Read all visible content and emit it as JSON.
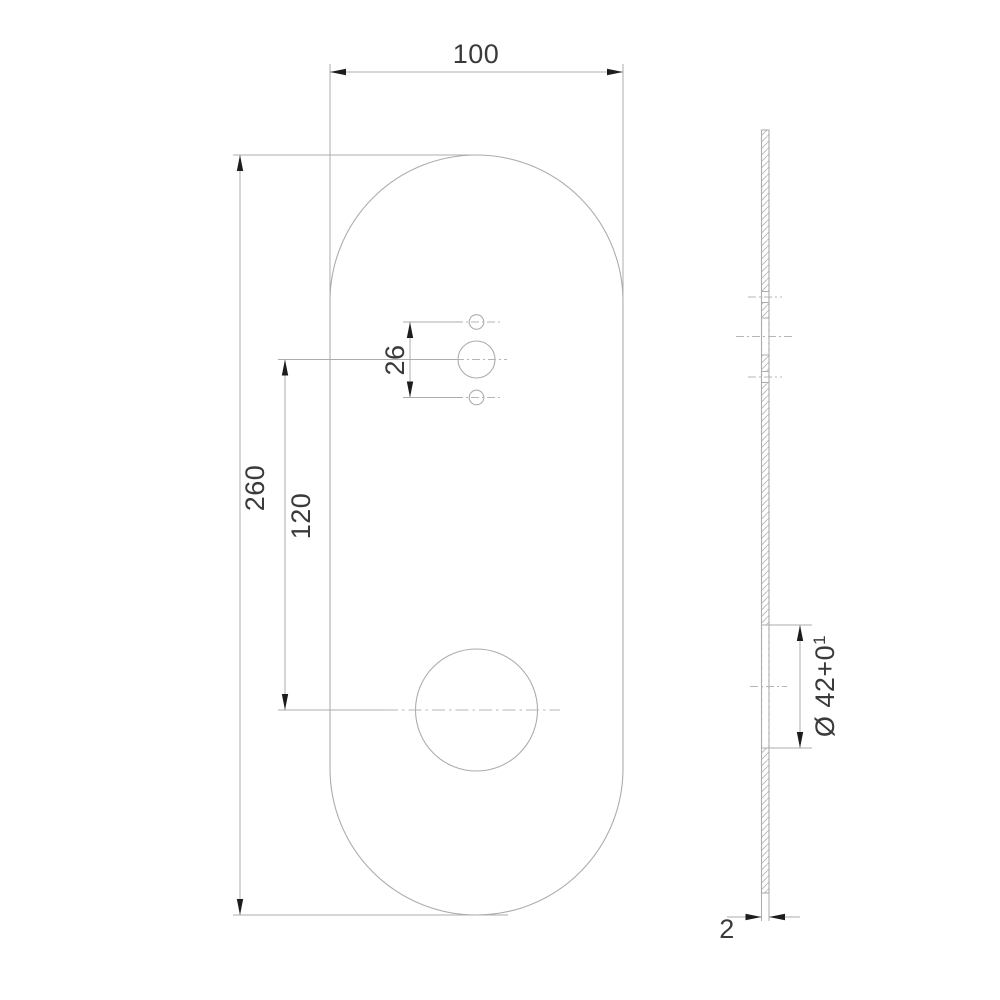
{
  "colors": {
    "background": "#ffffff",
    "line": "#a9adb0",
    "centerline": "#b2b6b8",
    "hatch": "#b2b6b8",
    "arrow": "#1d1d1f",
    "text": "#3a3a3c"
  },
  "front_view": {
    "dim_width": "100",
    "dim_height": "260",
    "dim_hole_offset": "120",
    "dim_hole_spacing": "26"
  },
  "side_view": {
    "dim_hole_diameter_main": "Ø 42+0",
    "dim_hole_diameter_sup": "1",
    "dim_thickness": "2"
  }
}
